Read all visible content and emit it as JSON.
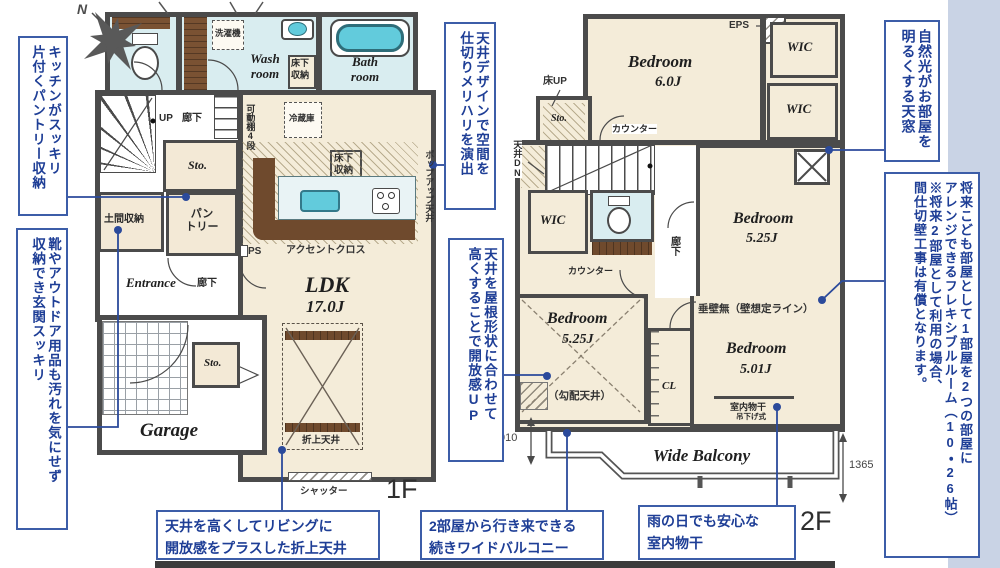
{
  "colors": {
    "accent_blue": "#2b4a9b",
    "wall": "#4b4b4b",
    "floor": "#f4ecd9",
    "wet": "#d9edf0",
    "water": "#62cbdc",
    "band": "#c9d3e5"
  },
  "compass": {
    "n": "N"
  },
  "callouts": {
    "left1": "キッチンがスッキリ\n片付くパントリー収納",
    "left2": "靴やアウトドア用品も汚れを気にせず\n収納でき玄関スッキリ",
    "mid1": "天井デザインで空間を\n仕切りメリハリを演出",
    "mid2": "天井を屋根形状に合わせて\n高くすることで開放感UP",
    "right1": "自然光がお部屋を\n明るくする天窓",
    "right2": "将来こども部屋として1部屋を2つの部屋に\nアレンジできるフレキシブルルーム（10・26帖）\n※将来2部屋として利用の場合、\n間仕切壁工事は有償となります。",
    "bottom1": "天井を高くしてリビングに\n開放感をプラスした折上天井",
    "bottom2": "2部屋から行き来できる\n続きワイドバルコニー",
    "bottom3": "雨の日でも安心な\n室内物干"
  },
  "plan1f": {
    "floor_label": "1F",
    "labels": {
      "washing_machine": "洗濯機",
      "wash_room": "Wash\nroom",
      "underfloor_storage_top": "床下収納",
      "bath_room": "Bath\nroom",
      "up": "UP",
      "hallway_top": "廊下",
      "movable_shelf": "可動棚4段",
      "fridge": "冷蔵庫",
      "storage_upper": "Sto.",
      "pantry": "パン\nトリー",
      "doma_storage": "土間収納",
      "entrance": "Entrance",
      "hallway_mid": "廊下",
      "ps": "PS",
      "accent_cross": "アクセントクロス",
      "underfloor_storage_ldk": "床下収納",
      "ldk_name": "LDK",
      "ldk_size": "17.0J",
      "popup_ceiling": "ポップアップ天井",
      "coffered_ceiling": "折上天井",
      "storage_lower": "Sto.",
      "garage": "Garage",
      "shutter": "シャッター"
    }
  },
  "plan2f": {
    "floor_label": "2F",
    "labels": {
      "bedroom6_name": "Bedroom",
      "bedroom6_size": "6.0J",
      "eps": "EPS",
      "wic_top": "WIC",
      "wic_mid": "WIC",
      "wic_left": "WIC",
      "floor_up": "床UP",
      "storage": "Sto.",
      "counter_top": "カウンター",
      "ceiling_dn": "天井DN",
      "dn": "DN",
      "counter_mid": "カウンター",
      "hallway": "廊下",
      "bedroom525r_name": "Bedroom",
      "bedroom525r_size": "5.25J",
      "no_wall": "垂壁無（壁想定ライン）",
      "bedroom525l_name": "Bedroom",
      "bedroom525l_size": "5.25J",
      "sloped_ceiling": "（勾配天井）",
      "cl": "CL",
      "bedroom501_name": "Bedroom",
      "bedroom501_size": "5.01J",
      "indoor_drying": "室内物干",
      "hanging_type": "吊下げ式",
      "balcony": "Wide Balcony",
      "dim_910": "910",
      "dim_1365": "1365"
    }
  }
}
